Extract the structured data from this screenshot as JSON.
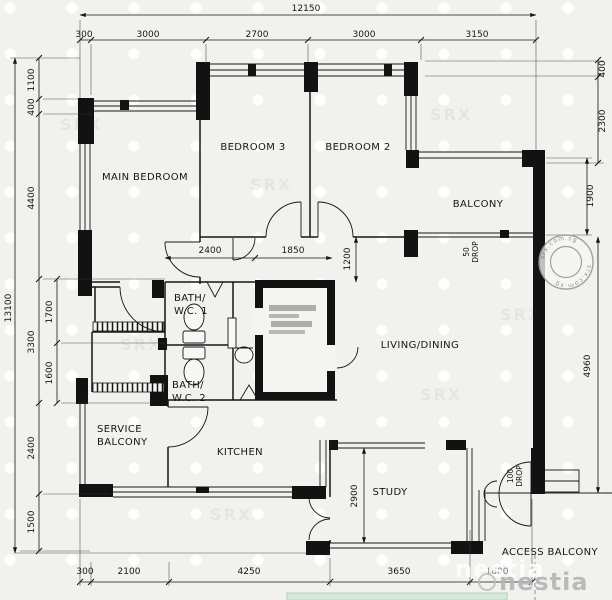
{
  "rooms": {
    "main_bedroom": "MAIN BEDROOM",
    "bedroom3": "BEDROOM 3",
    "bedroom2": "BEDROOM 2",
    "balcony": "BALCONY",
    "living_dining": "LIVING/DINING",
    "bath1_line1": "BATH/",
    "bath1_line2": "W.C.  1",
    "bath2_line1": "BATH/",
    "bath2_line2": "W.C.  2",
    "service_line1": "SERVICE",
    "service_line2": "BALCONY",
    "kitchen": "KITCHEN",
    "study": "STUDY",
    "access_balcony": "ACCESS BALCONY"
  },
  "ann": {
    "balcony_drop_value": "50",
    "balcony_drop_word": "DROP",
    "entrance_drop_value": "100",
    "entrance_drop_word": "DROP"
  },
  "dims": {
    "top_total": "12150",
    "top": [
      "300",
      "3000",
      "2700",
      "3000",
      "3150"
    ],
    "left_total": "13100",
    "left": [
      "1100",
      "400",
      "4400",
      "3300",
      "2400",
      "1500"
    ],
    "left_sub": [
      "1700",
      "1600"
    ],
    "right": [
      "400",
      "2300",
      "1900",
      "4960"
    ],
    "bottom": [
      "300",
      "2100",
      "4250",
      "3650",
      "1800"
    ],
    "interior": {
      "bath_width": "2400",
      "shelter_width": "1850",
      "hall_depth": "1200",
      "study_depth": "2900"
    }
  },
  "wm": {
    "stamp_text": "srx.com.sg",
    "stamp_text_2": "srx.com.sg",
    "brand": "nestia",
    "brand_shadow": "nestia",
    "pattern": "SRX"
  }
}
